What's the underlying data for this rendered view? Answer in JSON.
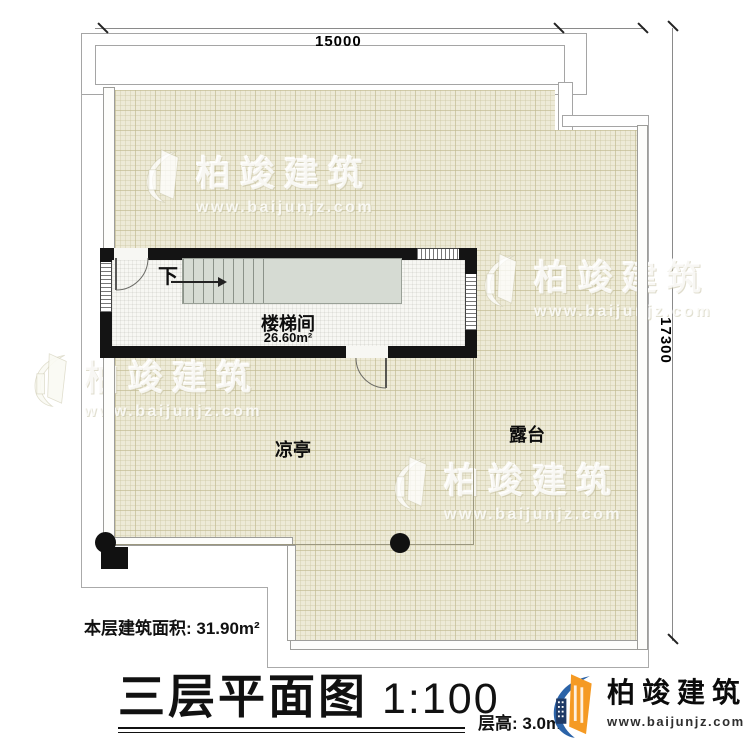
{
  "plan": {
    "dimensions": {
      "top": "15000",
      "right": "17300"
    },
    "rooms": {
      "stairwell": {
        "name": "楼梯间",
        "area": "26.60m²",
        "direction_label": "下"
      },
      "pavilion": {
        "name": "凉亭"
      },
      "terrace": {
        "name": "露台"
      }
    },
    "footer": {
      "floor_area": "本层建筑面积: 31.90m²",
      "title": "三层平面图",
      "scale": "1:100",
      "floor_height": "层高: 3.0m"
    }
  },
  "branding": {
    "logo_name": "柏竣建筑",
    "logo_url": "www.baijunjz.com",
    "watermark_name": "柏竣建筑",
    "watermark_url": "www.baijunjz.com"
  },
  "colors": {
    "tile": "#edead7",
    "wall": "#141414",
    "stair": "#d6dbd3",
    "logo_orange": "#f59a23",
    "logo_blue": "#2b63a8"
  }
}
